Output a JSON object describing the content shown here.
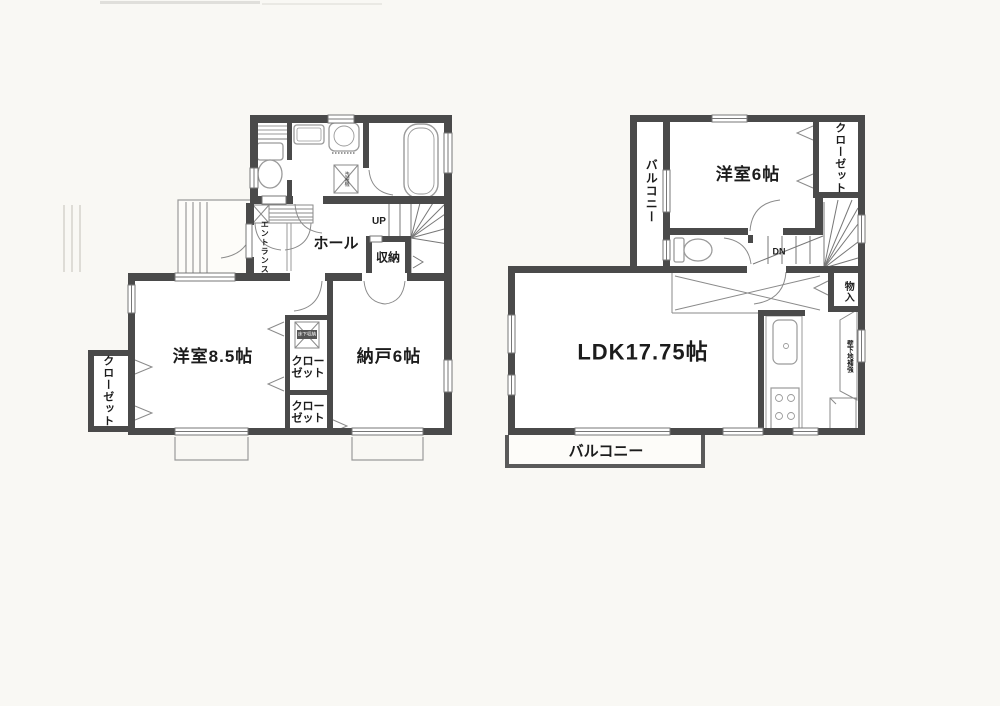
{
  "colors": {
    "wall": "#4a4a4a",
    "thin_line": "#8a8a8a",
    "fixture_line": "#9a9a9a",
    "text": "#1c1c1c",
    "background": "#f9f8f4"
  },
  "floor1": {
    "entrance_label": "エントランス",
    "hall_label": "ホール",
    "stairs_up_label": "UP",
    "storage_label": "収納",
    "bedroom_label": "洋室8.5帖",
    "storage_room_label": "納戸6帖",
    "closet_left_label": "クローゼット",
    "closet_center_upper_label": "クローゼット",
    "closet_center_lower_label": "クローゼット",
    "underfloor_storage_label": "床下収納",
    "washer_label": "洗濯機"
  },
  "floor2": {
    "bedroom_label": "洋室6帖",
    "closet_label": "クローゼット",
    "balcony_side_label": "バルコニー",
    "stairs_down_label": "DN",
    "storage_label": "物入",
    "ldk_label": "LDK17.75帖",
    "wall_note_label": "壁下地補強",
    "balcony_bottom_label": "バルコニー"
  }
}
